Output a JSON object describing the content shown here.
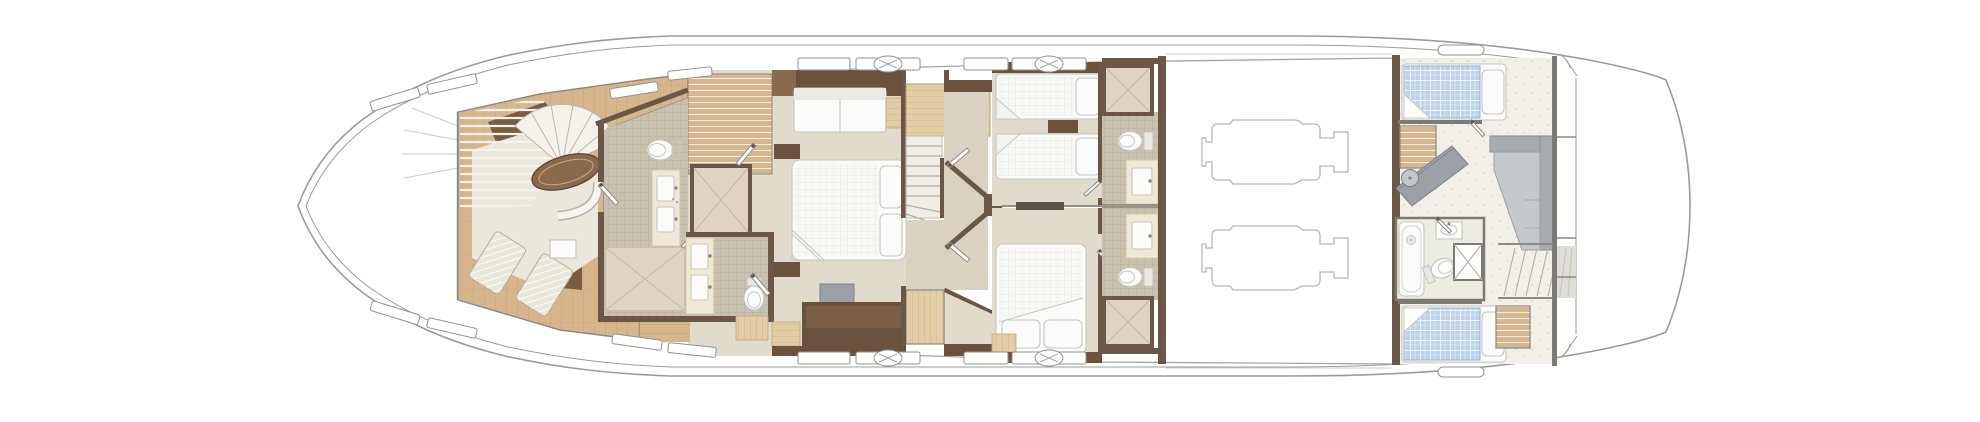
{
  "deck": {
    "name": "motor-yacht-lower-deck-floor-plan",
    "orientation": "bow-left",
    "rooms": [
      "bow-stowage",
      "forward-cabin-lounge",
      "forward-bathroom",
      "forward-day-head",
      "master-cabin",
      "main-staircase",
      "guest-lobby",
      "twin-guest-cabin",
      "double-guest-cabin",
      "twin-ensuite-bathroom",
      "double-ensuite-bathroom",
      "engine-room",
      "crew-mess",
      "crew-cabin-forward",
      "crew-cabin-aft",
      "crew-bathroom",
      "aft-steps",
      "transom-platform"
    ],
    "equipment": [
      "spiral-staircase",
      "oval-table",
      "curved-settee",
      "chaise-longue",
      "side-table",
      "double-bed",
      "single-bed",
      "sofa",
      "tv-unit",
      "toilet",
      "twin-sink-vanity",
      "shower",
      "bathtub",
      "wash-basin",
      "port-engine",
      "starboard-engine",
      "crew-counter-sink",
      "l-shaped-sofa",
      "wardrobe-louver",
      "deck-hatch",
      "hull-window"
    ]
  },
  "palette": {
    "hull": "#9b9b98",
    "wallDark": "#6a5747",
    "wallGrey": "#7d7a74",
    "woodDark": "#6b523c",
    "woodMid": "#8a6a4c",
    "woodLight": "#d7b68e",
    "woodPale": "#e3cda7",
    "floorBeige": "#e1dbce",
    "floorCorridor": "#d9d2c3",
    "tile": "#c9c1b0",
    "tileLine": "#b3ab9a",
    "shower": "#ded4c1",
    "carpet": "#ebe7dc",
    "crewFloor": "#f1efe8",
    "whiteFurn": "#fbfbf9",
    "furnLine": "#c6c6c1",
    "greyFurn": "#9ba1a6",
    "greyLight": "#c3c7ca",
    "blueMattress": "#bdd2e8",
    "engineLine": "#b8b8b5",
    "windowFrame": "#8f948f",
    "cream": "#efe8d6"
  }
}
